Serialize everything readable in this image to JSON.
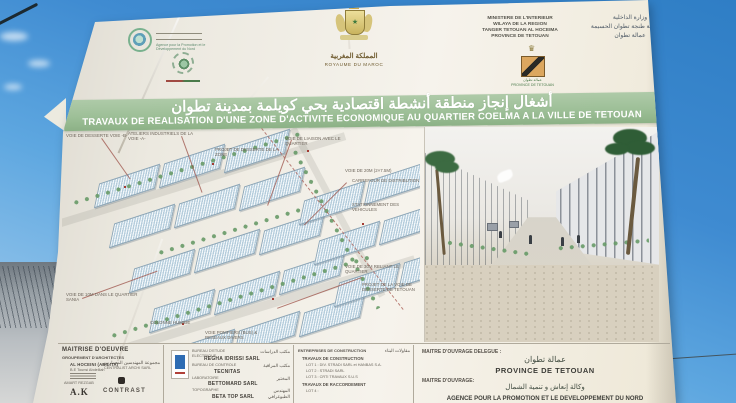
{
  "photo": {
    "billboard": {
      "header": {
        "apdn_caption_l1": "Agence pour la Promotion et le",
        "apdn_caption_l2": "Développement du Nord",
        "kingdom_ar": "المملكة المغربية",
        "kingdom_fr": "ROYAUME DU MAROC",
        "ministry_fr": [
          "MINISTERE DE L'INTERIEUR",
          "WILAYA DE LA REGION",
          "TANGER TETOUAN AL HOCEIMA",
          "PROVINCE DE TETOUAN"
        ],
        "ministry_ar": [
          "وزارة الداخلية",
          "ولاية جهة طنجة تطوان الحسيمة",
          "عمالة تطوان"
        ],
        "province_emblem_ar": "عمالة تطوان",
        "province_emblem_fr": "PROVINCE DE TETOUAN"
      },
      "banner": {
        "title_ar": "أشغال إنجاز منطقة أنشطة اقتصادية بحي كويلمة بمدينة تطوان",
        "title_fr": "TRAVAUX DE REALISATION D'UNE ZONE D'ACTIVITE ECONOMIQUE AU QUARTIER COELMA A LA VILLE DE TETOUAN"
      },
      "site_plan": {
        "annotations": [
          "VOIE DE DESSERTE VOIE -B-",
          "ATELIERS INDUSTRIELS DE LA VOIE -A-",
          "PROJET DE DESSERTE DE LA ZONE",
          "VOIE DE LIAISON AVEC LE QUARTIER",
          "VOIE DE 20m (2×7.5m)",
          "CARREFOUR DE DISTRIBUTION",
          "STATIONNEMENT DES VEHICULES",
          "PROJET DE LA VOIE DE DESSERTE DE TETOUAN",
          "VOIE DE 10m DANS LE QUARTIER SANIA",
          "COLONNE HUMIDE",
          "VOIE POMPIERS (BUS) & RESEAUX DIVERS",
          "VOIE DE 30m RELIANT LE QUARTIER"
        ]
      },
      "footer": {
        "col_architects": {
          "title": "MAITRISE D'OEUVRE",
          "subtitle_fr": "GROUPEMENT D'ARCHITECTES",
          "subtitle_ar": "مجموعة المهندسين المعماريين",
          "line1": "AL HOCEINI (ABILITA)",
          "line2": "B.E Tounsi Abdelilah",
          "logo1_caption": "AMART REZGAB",
          "logo1": "A.K",
          "logo2_caption": "CENTRALIST ARCHI SARL",
          "logo2": "CONTRAST"
        },
        "col_bureaux": {
          "rows": [
            {
              "label": "BUREAU D'ETUDE ELECTRIQUE",
              "label_ar": "مكتب الدراسات",
              "value": "REGHA IDRISSI SARL"
            },
            {
              "label": "BUREAU DE CONTROLE",
              "label_ar": "مكتب المراقبة",
              "value": "TECNITAS"
            },
            {
              "label": "LABORATOIRE",
              "label_ar": "المختبر",
              "value": "BETTOMARD SARL"
            },
            {
              "label": "TOPOGRAPHE",
              "label_ar": "المهندس الطبوغرافي",
              "value": "BETA TOP SARL"
            }
          ]
        },
        "col_entreprises": {
          "title_fr": "ENTREPRISES DE CONSTRUCTION",
          "title_ar": "مقاولات البناء",
          "section1": "TRAVAUX DE CONSTRUCTION",
          "lot1": "LOT 1 : DIV. STRADI SARL et HANBAS S.A.",
          "lot2": "LOT 2 : STRADI SARL",
          "lot3": "LOT 3 : CRTI TRAVAUX S.U.S",
          "section2": "TRAVAUX DE RACCORDEMENT",
          "lot4": "LOT 4 :"
        },
        "ownership": {
          "delegue_label": "MAITRE D'OUVRAGE DELEGUE :",
          "delegue_ar": "عمالة تطوان",
          "delegue_fr": "PROVINCE DE TETOUAN",
          "owner_label": "MAITRE D'OUVRAGE:",
          "owner_ar": "وكالة إنعاش و تنمية الشمال",
          "owner_fr": "AGENCE POUR LA PROMOTION ET LE DEVELOPPEMENT DU NORD"
        }
      }
    },
    "colors": {
      "sky_top": "#2f7ec5",
      "sky_light": "#bcdcf4",
      "board": "#f2efe7",
      "banner_green": "#9cbf97",
      "emblem_gold": "#c5b061",
      "shield_tan": "#dca75f",
      "plan_roof_blue": "#b5cddc",
      "annotation_red": "#9c5148"
    }
  }
}
